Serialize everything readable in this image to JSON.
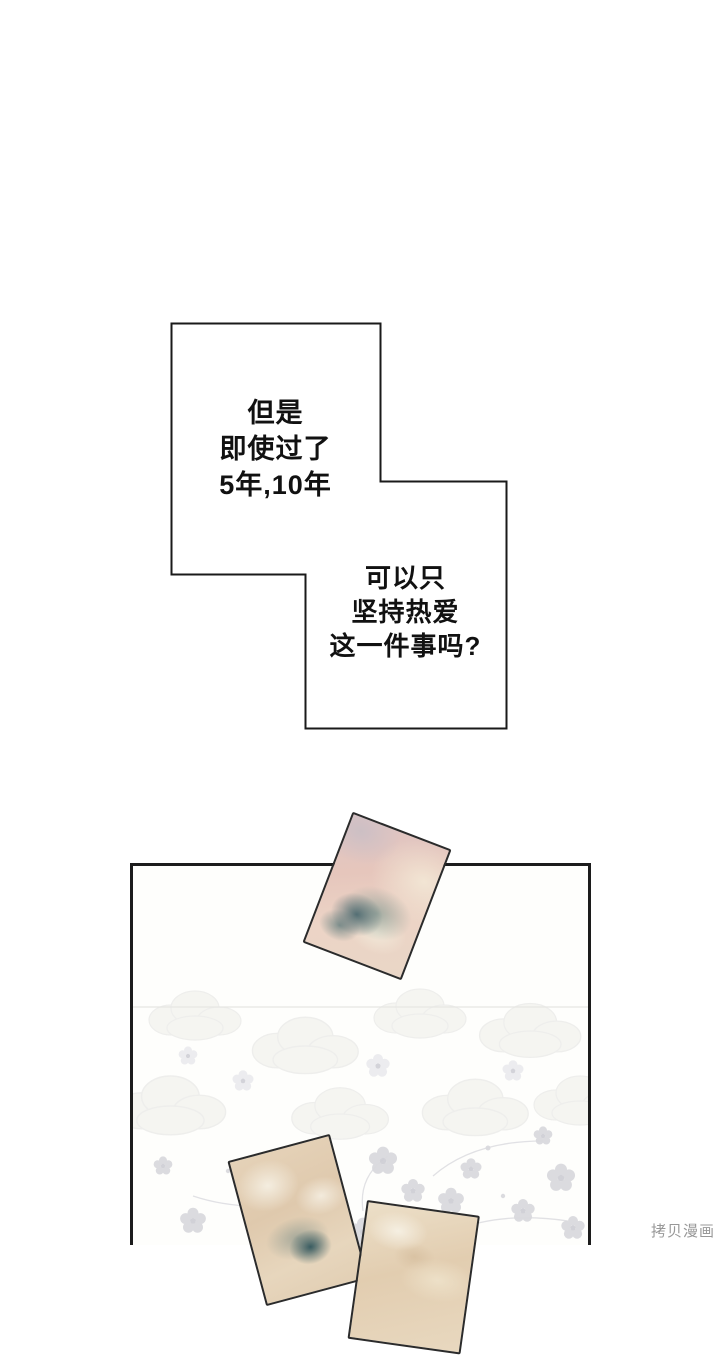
{
  "comic": {
    "background_color": "#ffffff",
    "bubble": {
      "border_color": "#1a1a1a",
      "fill_color": "#ffffff",
      "text_color": "#111111",
      "block_a": {
        "lines": [
          "但是",
          "即使过了",
          "5年,10年"
        ]
      },
      "block_b": {
        "lines": [
          "可以只",
          "坚持热爱",
          "这一件事吗?"
        ]
      }
    },
    "panel": {
      "border_color": "#1c1c1c",
      "background_color": "#fefefc",
      "pattern": "faint-floral-wallpaper",
      "pattern_colors": [
        "#f3f3ef",
        "#ececea",
        "#dadade",
        "#cfcfd6"
      ]
    },
    "cards": [
      {
        "id": "photo-card-top",
        "style": "watercolor",
        "colors": [
          "#e6c6bc",
          "#f3e8d6",
          "#c9bec5",
          "#3e6068",
          "#7a968e"
        ]
      },
      {
        "id": "photo-card-bottom-left",
        "style": "watercolor",
        "colors": [
          "#dfc9ad",
          "#f4eee0",
          "#285058"
        ]
      },
      {
        "id": "photo-card-bottom-right",
        "style": "watercolor",
        "colors": [
          "#e2cdb0",
          "#f7f2e6",
          "#d0b796"
        ]
      }
    ],
    "watermark": {
      "text": "拷贝漫画",
      "color": "#989898"
    }
  }
}
